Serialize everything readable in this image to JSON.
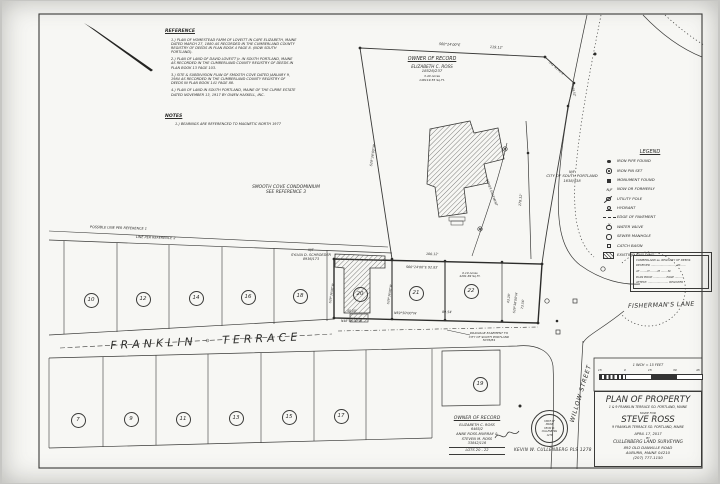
{
  "reference": {
    "title": "REFERENCE",
    "items": [
      "1.) PLAN OF HOMESTEAD FARM OF LOVEITT IN CAPE ELIZABETH, MAINE DATED MARCH 27, 1880 AS RECORDED IN THE CUMBERLAND COUNTY REGISTRY OF DEEDS IN PLAN BOOK 4 PAGE 8. (NOW SOUTH PORTLAND).",
      "2.) PLAN OF LAND OF DAVID LOVEITT Jr. IN SOUTH PORTLAND, MAINE AS RECORDED IN THE CUMBERLAND COUNTY REGISTRY OF DEEDS IN PLAN BOOK 13 PAGE 103.",
      "3.) SITE & SUBDIVISION PLAN OF SMOOTH COVE DATED JANUARY 9, 1984 AS RECORDED IN THE CUMBERLAND COUNTY REGISTRY OF DEEDS IN PLAN BOOK 141 PAGE 88.",
      "4.) PLAN OF LAND IN SOUTH PORTLAND, MAINE OF THE CURRE ESTATE DATED NOVEMBER 13, 1917 BY OWEN HASKELL, INC."
    ]
  },
  "notes": {
    "title": "NOTES",
    "items": [
      "1.) BEARINGS ARE REFERENCED TO MAGNETIC NORTH 1977"
    ]
  },
  "owner_top": {
    "title": "OWNER OF RECORD",
    "name": "ELIZABETH C. ROSS",
    "book_page": "18526/237",
    "acres": "3.40 Acres",
    "sqft": "148119.55 Sq.Ft."
  },
  "neighbors": {
    "smooth_cove_line1": "SMOOTH COVE CONDOMINIUM",
    "smooth_cove_line2": "SEE REFERENCE 3",
    "city_nf": "N/F",
    "city_name": "CITY OF SOUTH PORTLAND",
    "city_book": "1638/438",
    "schroeder_nf": "N/F",
    "schroeder_name": "SYLVIA D. SCHROEDER",
    "schroeder_book": "8936/173"
  },
  "line_labels": {
    "possible_ref1": "POSSIBLE LINE PER REFERENCE 1",
    "ref2": "LINE PER REFERENCE 2",
    "sewer": "SEWER EASEMENT"
  },
  "streets": {
    "franklin": "FRANKLIN ◦ TERRACE",
    "fishermans": "FISHERMAN'S LANE",
    "willow": "WILLOW STREET"
  },
  "easement": {
    "line1": "DRAINAGE EASEMENT TO",
    "line2": "CITY OF SOUTH PORTLAND",
    "line3": "5076/84"
  },
  "dimensions": {
    "d1_bearing": "S60°24'00\"E",
    "d1_len": "119.12'",
    "d2_len": "100.12'",
    "d3": "S60°24'00\"E  92.83'",
    "d4_bearing": "N59°50'00\"W",
    "d4_len": "89.54'",
    "d5_len": "40.00'",
    "d5_bearing": "N48°58'30\"W",
    "d6_len": "43.28'",
    "d6_bearing": "S29°36'00\"W",
    "d7_len": "73.56'",
    "d8_len": "178.12'",
    "d9_bearing": "S29°36'00\"W",
    "d10_bearing": "S29°36'00\"W",
    "d11_bearing": "S29°36'00\"W",
    "ne1": "S41°43'00\"E",
    "ne2": "44.52'"
  },
  "lot22_area": {
    "acres": "0.10 Acres",
    "sqft": "4291.69 Sq.Ft."
  },
  "lots": {
    "north": [
      "10",
      "12",
      "14",
      "16",
      "18",
      "20",
      "21",
      "22"
    ],
    "south": [
      "7",
      "9",
      "11",
      "13",
      "15",
      "17",
      "19"
    ]
  },
  "legend": {
    "title": "LEGEND",
    "nf_symbol_text": "N/F",
    "items": [
      {
        "symbol": "iron-pipe-found",
        "label": "IRON PIPE FOUND"
      },
      {
        "symbol": "iron-pin-set",
        "label": "IRON PIN SET"
      },
      {
        "symbol": "monument-found",
        "label": "MONUMENT FOUND"
      },
      {
        "symbol": "now-or-formerly",
        "label": "NOW OR FORMERLY"
      },
      {
        "symbol": "utility-pole",
        "label": "UTILITY POLE"
      },
      {
        "symbol": "hydrant",
        "label": "HYDRANT"
      },
      {
        "symbol": "edge-of-pavement",
        "label": "EDGE OF PAVEMENT"
      },
      {
        "symbol": "water-valve",
        "label": "WATER VALVE"
      },
      {
        "symbol": "sewer-manhole",
        "label": "SEWER MANHOLE"
      },
      {
        "symbol": "catch-basin",
        "label": "CATCH BASIN"
      },
      {
        "symbol": "existing-building",
        "label": "EXISTING BUILDING"
      }
    ]
  },
  "recording": {
    "lines": [
      "CUMBERLAND ss. REGISTRY OF DEEDS",
      "RECEIVED ..........................., 20......",
      "AT ........H ........M ........M.",
      "PLAN BOOK .............. PAGE ..........",
      "ATTEST: ....................... REGISTER"
    ]
  },
  "scalebar": {
    "caption": "1 INCH = 15 FEET",
    "ticks": [
      "15",
      "0",
      "15",
      "30",
      "45"
    ]
  },
  "title_block": {
    "title": "PLAN OF PROPERTY",
    "subtitle": "1 & 9 FRANKLIN TERRACE   SO. PORTLAND, MAINE",
    "made_for": "MADE FOR",
    "client": "STEVE ROSS",
    "client_addr": "9 FRANKLIN TERRACE   SO. PORTLAND, MAINE",
    "date": "APRIL 17, 2017",
    "by": "BY",
    "firm": "CULLENBERG LAND SURVEYING",
    "firm_addr1": "892 OLD DANVILLE ROAD",
    "firm_addr2": "AUBURN, MAINE 04210",
    "firm_phone": "(207) 777-1150"
  },
  "owner_bottom": {
    "title": "OWNER OF RECORD",
    "lines": [
      "ELIZABETH C. ROSS",
      "6465/2",
      "ANNE ROSS-MURRAY &",
      "STEVEN M. ROSS",
      "33842/116"
    ],
    "lots": "LOTS 20 - 22"
  },
  "surveyor": {
    "name": "KEVIN W. CULLENBERG PLS 1278",
    "seal": [
      "STATE OF",
      "MAINE",
      "KEVIN W.",
      "CULLENBERG",
      "1278"
    ]
  }
}
